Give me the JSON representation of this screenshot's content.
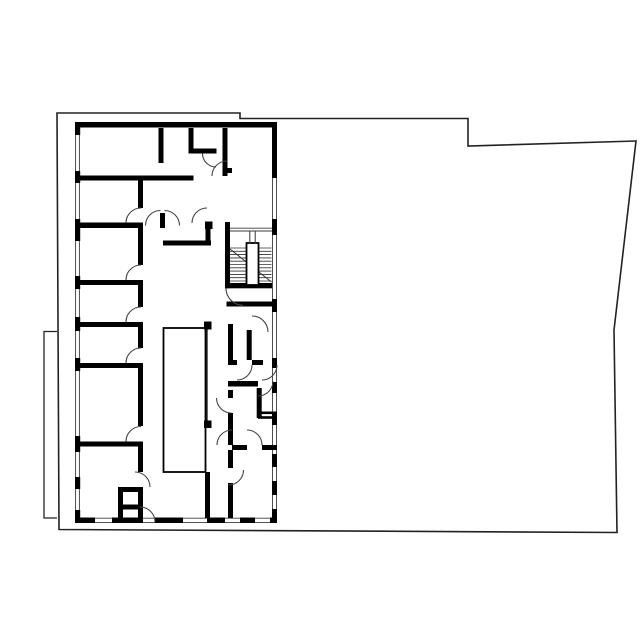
{
  "meta": {
    "document_type": "architectural-floor-plan",
    "visible_text": [],
    "background_color": "#ffffff",
    "wall_color": "#000000",
    "outline_color": "#222222",
    "thin_line_color": "#3a3a3a",
    "door_arc_color": "#444444"
  },
  "floorplan": {
    "canvas": {
      "width": 640,
      "height": 640
    },
    "style": {
      "ink": "#000000",
      "thin": "#3a3a3a"
    },
    "layers": [
      {
        "name": "parcel-outline",
        "items": [
          {
            "kind": "path",
            "d": "M57,113 L240,113 L240,118.5 L468,118.5 L468,146 L636,141 L614,330 L617,532.5 L59,529.5 Z",
            "stroke": "#222222",
            "sw": 1.6
          },
          {
            "kind": "path",
            "d": "M57,331.5 L44,331.5 L44,518 L57,518",
            "stroke": "#222222",
            "sw": 1.3
          }
        ]
      },
      {
        "name": "window-lines",
        "items": [
          {
            "kind": "line",
            "x1": 75.6,
            "y1": 127,
            "x2": 75.6,
            "y2": 517.5,
            "sw": 0.9
          },
          {
            "kind": "line",
            "x1": 79.4,
            "y1": 127,
            "x2": 79.4,
            "y2": 517.5,
            "sw": 0.9
          },
          {
            "kind": "line",
            "x1": 272.5,
            "y1": 127,
            "x2": 272.5,
            "y2": 517.5,
            "sw": 0.9
          },
          {
            "kind": "line",
            "x1": 276.5,
            "y1": 127,
            "x2": 276.5,
            "y2": 517.5,
            "sw": 0.9
          },
          {
            "kind": "line",
            "x1": 75,
            "y1": 518.2,
            "x2": 277,
            "y2": 518.2,
            "sw": 0.9
          },
          {
            "kind": "line",
            "x1": 75,
            "y1": 522.6,
            "x2": 277,
            "y2": 522.6,
            "sw": 0.9
          },
          {
            "kind": "line",
            "x1": 230,
            "y1": 228.2,
            "x2": 272,
            "y2": 228.2,
            "sw": 0.9
          },
          {
            "kind": "line",
            "x1": 230,
            "y1": 231,
            "x2": 272,
            "y2": 231,
            "sw": 0.9
          }
        ]
      },
      {
        "name": "walls",
        "items": [
          {
            "kind": "rect",
            "x": 75,
            "y": 122,
            "w": 202,
            "h": 5.5
          },
          {
            "kind": "rect",
            "x": 75,
            "y": 122,
            "w": 5.2,
            "h": 13
          },
          {
            "kind": "rect",
            "x": 75,
            "y": 171,
            "w": 5.2,
            "h": 12
          },
          {
            "kind": "rect",
            "x": 75,
            "y": 219,
            "w": 5.2,
            "h": 22
          },
          {
            "kind": "rect",
            "x": 75,
            "y": 276,
            "w": 5.2,
            "h": 13
          },
          {
            "kind": "rect",
            "x": 75,
            "y": 317,
            "w": 5.2,
            "h": 14
          },
          {
            "kind": "rect",
            "x": 75,
            "y": 358,
            "w": 5.2,
            "h": 13
          },
          {
            "kind": "rect",
            "x": 75,
            "y": 436,
            "w": 5.2,
            "h": 16
          },
          {
            "kind": "rect",
            "x": 75,
            "y": 477,
            "w": 5.2,
            "h": 12
          },
          {
            "kind": "rect",
            "x": 75,
            "y": 510,
            "w": 5.2,
            "h": 8
          },
          {
            "kind": "rect",
            "x": 272,
            "y": 122,
            "w": 5,
            "h": 56
          },
          {
            "kind": "rect",
            "x": 272,
            "y": 219,
            "w": 5,
            "h": 16
          },
          {
            "kind": "rect",
            "x": 272,
            "y": 299,
            "w": 5,
            "h": 13
          },
          {
            "kind": "rect",
            "x": 272,
            "y": 358,
            "w": 5,
            "h": 10
          },
          {
            "kind": "rect",
            "x": 272,
            "y": 382,
            "w": 5,
            "h": 11
          },
          {
            "kind": "rect",
            "x": 272,
            "y": 412,
            "w": 5,
            "h": 13
          },
          {
            "kind": "rect",
            "x": 272,
            "y": 454,
            "w": 5,
            "h": 13
          },
          {
            "kind": "rect",
            "x": 272,
            "y": 481,
            "w": 5,
            "h": 14
          },
          {
            "kind": "rect",
            "x": 272,
            "y": 509,
            "w": 5,
            "h": 9
          },
          {
            "kind": "rect",
            "x": 75,
            "y": 517.5,
            "w": 20,
            "h": 5.5
          },
          {
            "kind": "rect",
            "x": 112,
            "y": 517.5,
            "w": 31,
            "h": 5.5
          },
          {
            "kind": "rect",
            "x": 155,
            "y": 517.5,
            "w": 28,
            "h": 5.5
          },
          {
            "kind": "rect",
            "x": 207,
            "y": 517.5,
            "w": 18,
            "h": 5.5
          },
          {
            "kind": "rect",
            "x": 240,
            "y": 517.5,
            "w": 15,
            "h": 5.5
          },
          {
            "kind": "rect",
            "x": 270,
            "y": 517.5,
            "w": 7,
            "h": 5.5
          },
          {
            "kind": "rect",
            "x": 80,
            "y": 175.5,
            "w": 113.5,
            "h": 5
          },
          {
            "kind": "rect",
            "x": 80,
            "y": 222.5,
            "w": 63,
            "h": 5.5
          },
          {
            "kind": "rect",
            "x": 80,
            "y": 280,
            "w": 63,
            "h": 5
          },
          {
            "kind": "rect",
            "x": 80,
            "y": 322,
            "w": 63,
            "h": 5
          },
          {
            "kind": "rect",
            "x": 80,
            "y": 363,
            "w": 63,
            "h": 5
          },
          {
            "kind": "rect",
            "x": 80,
            "y": 441.5,
            "w": 63,
            "h": 5
          },
          {
            "kind": "rect",
            "x": 138,
            "y": 180.5,
            "w": 5,
            "h": 27.5
          },
          {
            "kind": "rect",
            "x": 138,
            "y": 228,
            "w": 5,
            "h": 37
          },
          {
            "kind": "rect",
            "x": 138,
            "y": 285,
            "w": 5,
            "h": 22
          },
          {
            "kind": "rect",
            "x": 138,
            "y": 327,
            "w": 5,
            "h": 21
          },
          {
            "kind": "rect",
            "x": 138,
            "y": 368,
            "w": 5,
            "h": 58
          },
          {
            "kind": "rect",
            "x": 138,
            "y": 446.5,
            "w": 5,
            "h": 25.5
          },
          {
            "kind": "rect",
            "x": 138,
            "y": 487,
            "w": 5,
            "h": 35
          },
          {
            "kind": "rect",
            "x": 158.5,
            "y": 128,
            "w": 5,
            "h": 35
          },
          {
            "kind": "rect",
            "x": 188.5,
            "y": 128,
            "w": 5,
            "h": 25.5
          },
          {
            "kind": "rect",
            "x": 190,
            "y": 148.5,
            "w": 26.5,
            "h": 5
          },
          {
            "kind": "rect",
            "x": 222.5,
            "y": 128,
            "w": 5,
            "h": 48
          },
          {
            "kind": "rect",
            "x": 227.5,
            "y": 168,
            "w": 4.5,
            "h": 5
          },
          {
            "kind": "rect",
            "x": 160,
            "y": 213,
            "w": 5,
            "h": 15
          },
          {
            "kind": "rect",
            "x": 205,
            "y": 221.5,
            "w": 7.5,
            "h": 7.5
          },
          {
            "kind": "rect",
            "x": 205.5,
            "y": 229,
            "w": 5,
            "h": 16.5
          },
          {
            "kind": "rect",
            "x": 163,
            "y": 240.5,
            "w": 48,
            "h": 5
          },
          {
            "kind": "rect",
            "x": 225,
            "y": 222,
            "w": 5,
            "h": 66.3
          },
          {
            "kind": "rect",
            "x": 225,
            "y": 283,
            "w": 47,
            "h": 5.3
          },
          {
            "kind": "rect",
            "x": 226.5,
            "y": 301.5,
            "w": 50.5,
            "h": 5
          },
          {
            "kind": "rect",
            "x": 228,
            "y": 324,
            "w": 5,
            "h": 41
          },
          {
            "kind": "rect",
            "x": 246.7,
            "y": 330,
            "w": 5,
            "h": 30
          },
          {
            "kind": "rect",
            "x": 228,
            "y": 360,
            "w": 9,
            "h": 5
          },
          {
            "kind": "rect",
            "x": 252,
            "y": 360,
            "w": 11,
            "h": 5
          },
          {
            "kind": "rect",
            "x": 228,
            "y": 381,
            "w": 30,
            "h": 5.5
          },
          {
            "kind": "rect",
            "x": 256.7,
            "y": 388,
            "w": 5,
            "h": 30
          },
          {
            "kind": "rect",
            "x": 228,
            "y": 390,
            "w": 5,
            "h": 8
          },
          {
            "kind": "rect",
            "x": 228,
            "y": 413,
            "w": 5,
            "h": 32
          },
          {
            "kind": "rect",
            "x": 232,
            "y": 445,
            "w": 15,
            "h": 5
          },
          {
            "kind": "rect",
            "x": 262,
            "y": 445,
            "w": 15,
            "h": 5
          },
          {
            "kind": "rect",
            "x": 228,
            "y": 450,
            "w": 5,
            "h": 18
          },
          {
            "kind": "rect",
            "x": 228,
            "y": 483,
            "w": 5,
            "h": 35
          },
          {
            "kind": "rect",
            "x": 258,
            "y": 411.5,
            "w": 19,
            "h": 2.6
          },
          {
            "kind": "rect",
            "x": 258,
            "y": 416.2,
            "w": 19,
            "h": 2.6
          },
          {
            "kind": "rect",
            "x": 205,
            "y": 472,
            "w": 5,
            "h": 46
          },
          {
            "kind": "rect",
            "x": 204,
            "y": 321.5,
            "w": 7.5,
            "h": 8
          },
          {
            "kind": "rect",
            "x": 204,
            "y": 420.5,
            "w": 7.5,
            "h": 7.5
          },
          {
            "kind": "rect",
            "x": 118,
            "y": 487,
            "w": 5,
            "h": 35
          },
          {
            "kind": "rect",
            "x": 118,
            "y": 487,
            "w": 25,
            "h": 5
          },
          {
            "kind": "rect",
            "x": 118,
            "y": 504.5,
            "w": 25,
            "h": 5
          },
          {
            "kind": "rect",
            "x": 163.5,
            "y": 328,
            "w": 42,
            "h": 144,
            "fill": "none",
            "stroke": "#000000",
            "sw": 1.8
          },
          {
            "kind": "line",
            "x1": 207,
            "y1": 328,
            "x2": 207,
            "y2": 421,
            "stroke": "#000000",
            "sw": 1.2
          }
        ]
      },
      {
        "name": "stairs",
        "items": [
          {
            "kind": "line",
            "x1": 230,
            "y1": 248,
            "x2": 271.5,
            "y2": 248,
            "stroke": "#333333",
            "sw": 0.85
          },
          {
            "kind": "line",
            "x1": 230,
            "y1": 251.3,
            "x2": 271.5,
            "y2": 251.3,
            "stroke": "#333333",
            "sw": 0.85
          },
          {
            "kind": "line",
            "x1": 230,
            "y1": 254.6,
            "x2": 271.5,
            "y2": 254.6,
            "stroke": "#333333",
            "sw": 0.85
          },
          {
            "kind": "line",
            "x1": 230,
            "y1": 257.9,
            "x2": 271.5,
            "y2": 257.9,
            "stroke": "#333333",
            "sw": 0.85
          },
          {
            "kind": "line",
            "x1": 230,
            "y1": 261.2,
            "x2": 271.5,
            "y2": 261.2,
            "stroke": "#333333",
            "sw": 0.85
          },
          {
            "kind": "line",
            "x1": 230,
            "y1": 264.5,
            "x2": 271.5,
            "y2": 264.5,
            "stroke": "#333333",
            "sw": 0.85
          },
          {
            "kind": "line",
            "x1": 230,
            "y1": 267.8,
            "x2": 271.5,
            "y2": 267.8,
            "stroke": "#333333",
            "sw": 0.85
          },
          {
            "kind": "line",
            "x1": 230,
            "y1": 271.1,
            "x2": 271.5,
            "y2": 271.1,
            "stroke": "#333333",
            "sw": 0.85
          },
          {
            "kind": "line",
            "x1": 230,
            "y1": 274.4,
            "x2": 271.5,
            "y2": 274.4,
            "stroke": "#333333",
            "sw": 0.85
          },
          {
            "kind": "line",
            "x1": 230,
            "y1": 277.7,
            "x2": 271.5,
            "y2": 277.7,
            "stroke": "#333333",
            "sw": 0.85
          },
          {
            "kind": "line",
            "x1": 230,
            "y1": 281,
            "x2": 271.5,
            "y2": 281,
            "stroke": "#333333",
            "sw": 0.85
          },
          {
            "kind": "line",
            "x1": 230,
            "y1": 249,
            "x2": 271.5,
            "y2": 282,
            "stroke": "#333333",
            "sw": 1
          },
          {
            "kind": "rect",
            "x": 246.5,
            "y": 243,
            "w": 12,
            "h": 42,
            "fill": "#ffffff",
            "stroke": "#000000",
            "sw": 1.8
          },
          {
            "kind": "line",
            "x1": 249.8,
            "y1": 231.5,
            "x2": 249.8,
            "y2": 243.5,
            "stroke": "#333333",
            "sw": 1
          },
          {
            "kind": "line",
            "x1": 255.2,
            "y1": 231.5,
            "x2": 255.2,
            "y2": 243.5,
            "stroke": "#333333",
            "sw": 1
          }
        ]
      },
      {
        "name": "door-arcs",
        "items": [
          {
            "kind": "path",
            "d": "M126,223 A15,15 0 0 1 141,208",
            "stroke": "#444444",
            "sw": 1.1
          },
          {
            "kind": "path",
            "d": "M126,280 A15,15 0 0 1 141,265",
            "stroke": "#444444",
            "sw": 1.1
          },
          {
            "kind": "path",
            "d": "M126,322 A15,15 0 0 1 141,307",
            "stroke": "#444444",
            "sw": 1.1
          },
          {
            "kind": "path",
            "d": "M126,363 A15,15 0 0 1 141,348",
            "stroke": "#444444",
            "sw": 1.1
          },
          {
            "kind": "path",
            "d": "M126,441.5 A15,15 0 0 1 141,426.5",
            "stroke": "#444444",
            "sw": 1.1
          },
          {
            "kind": "path",
            "d": "M135,472 A15,15 0 0 1 150,487",
            "stroke": "#444444",
            "sw": 1.1
          },
          {
            "kind": "path",
            "d": "M140,507 A15,15 0 0 1 155,522",
            "stroke": "#444444",
            "sw": 1.1
          },
          {
            "kind": "path",
            "d": "M145.5,225.5 A15,15 0 0 1 160.5,210.5",
            "stroke": "#444444",
            "sw": 1.1
          },
          {
            "kind": "path",
            "d": "M164.5,210.5 A15,15 0 0 1 179.5,225.5",
            "stroke": "#444444",
            "sw": 1.1
          },
          {
            "kind": "path",
            "d": "M192,223 A15,15 0 0 1 207,208",
            "stroke": "#444444",
            "sw": 1.1
          },
          {
            "kind": "path",
            "d": "M202.5,153.5 A13.5,13.5 0 0 0 216,167",
            "stroke": "#444444",
            "sw": 1.1
          },
          {
            "kind": "path",
            "d": "M212,176 A15,15 0 0 1 227,161",
            "stroke": "#444444",
            "sw": 1.1
          },
          {
            "kind": "path",
            "d": "M226,288.3 A17,17 0 0 0 243,305.3",
            "stroke": "#444444",
            "sw": 1.1
          },
          {
            "kind": "path",
            "d": "M252,316 A16,16 0 0 1 268,332",
            "stroke": "#444444",
            "sw": 1.1
          },
          {
            "kind": "path",
            "d": "M237,380 A15,15 0 0 0 252,365",
            "stroke": "#444444",
            "sw": 1.1
          },
          {
            "kind": "path",
            "d": "M262,380 A15,15 0 0 0 277,365",
            "stroke": "#444444",
            "sw": 1.1
          },
          {
            "kind": "path",
            "d": "M273,381 A15,15 0 0 1 258,396",
            "stroke": "#444444",
            "sw": 1.1
          },
          {
            "kind": "path",
            "d": "M216.5,398 A15,15 0 0 0 231.5,413",
            "stroke": "#444444",
            "sw": 1.1
          },
          {
            "kind": "path",
            "d": "M217,445 A15,15 0 0 1 232,430",
            "stroke": "#444444",
            "sw": 1.1
          },
          {
            "kind": "path",
            "d": "M247,430 A15,15 0 0 1 262,445",
            "stroke": "#444444",
            "sw": 1.1
          },
          {
            "kind": "path",
            "d": "M243.5,470 A15,15 0 0 1 228.5,485",
            "stroke": "#444444",
            "sw": 1.1
          }
        ]
      }
    ]
  }
}
